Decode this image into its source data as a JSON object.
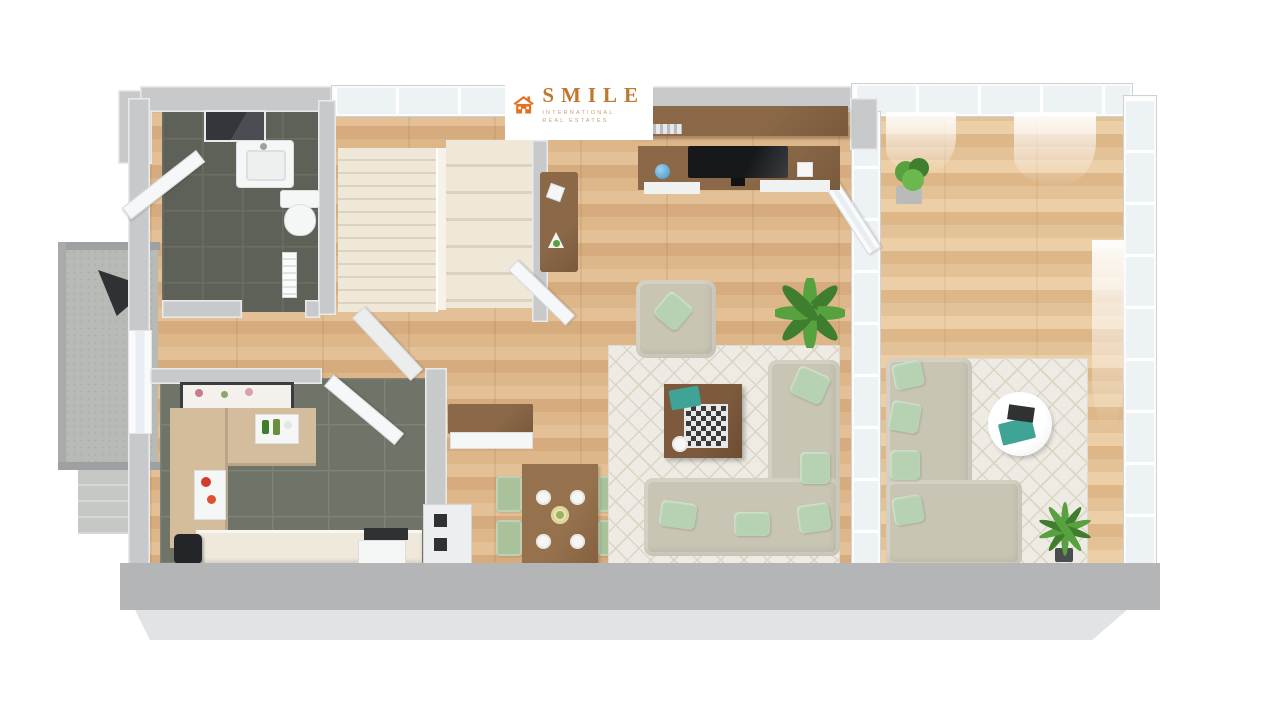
{
  "logo": {
    "brand": "SMILE",
    "tagline1": "INTERNATIONAL",
    "tagline2": "REAL ESTATES",
    "icon": "house-icon"
  },
  "scene": {
    "type": "3d-floor-plan-top-down-render",
    "rooms": [
      "bathroom",
      "staircase",
      "hallway",
      "kitchen",
      "dining-area",
      "living-room",
      "sunroom-lounge",
      "balcony"
    ],
    "furniture": [
      "vanity-sink",
      "mirror",
      "toilet",
      "radiator",
      "console-table",
      "hall-cabinet",
      "kitchen-counter",
      "bottle-tray",
      "fruit-tray",
      "wall-picture",
      "sink-unit",
      "oven",
      "cooktop",
      "dining-table",
      "dining-chairs",
      "dinner-plates",
      "tv-wall-unit",
      "television",
      "globe",
      "armchair",
      "coffee-table",
      "chess-board",
      "sectional-sofa-living",
      "sectional-sofa-sunroom",
      "round-coffee-table",
      "area-rug-living",
      "area-rug-sunroom",
      "potted-plant-living",
      "potted-plant-sunroom",
      "palm-plant",
      "parasol",
      "entry-door",
      "balcony-steps"
    ]
  },
  "palette": {
    "wood": "#ddb68a",
    "wood2": "#e3c095",
    "tile": "#6f7368",
    "tileLine": "#7e8277",
    "bathTile": "#5d6158",
    "wall": "#c7c9cb",
    "wallTop": "#e9eaec",
    "glass": "#edf2f5",
    "stairs": "#efe8d9",
    "stairLine": "#dbd2bf",
    "rug": "#edebe3",
    "rugLine": "#dcd5c5",
    "sofa": "#c9c5b4",
    "pillow": "#b7d2b2",
    "woodBrown": "#8a6848",
    "chair": "#a9c29b",
    "concrete": "#b8bab6",
    "bandDark": "#b3b5b7",
    "bandLight": "#e1e3e5",
    "counter": "#d3bd9c",
    "dark": "#2f3133",
    "orange": "#e5701d",
    "brandText": "#c0772e",
    "tagText": "#c9a27a",
    "green1": "#58a13f",
    "green2": "#3f7d2f",
    "accentTeal": "#3fa396",
    "blue": "#5aa7d6"
  }
}
